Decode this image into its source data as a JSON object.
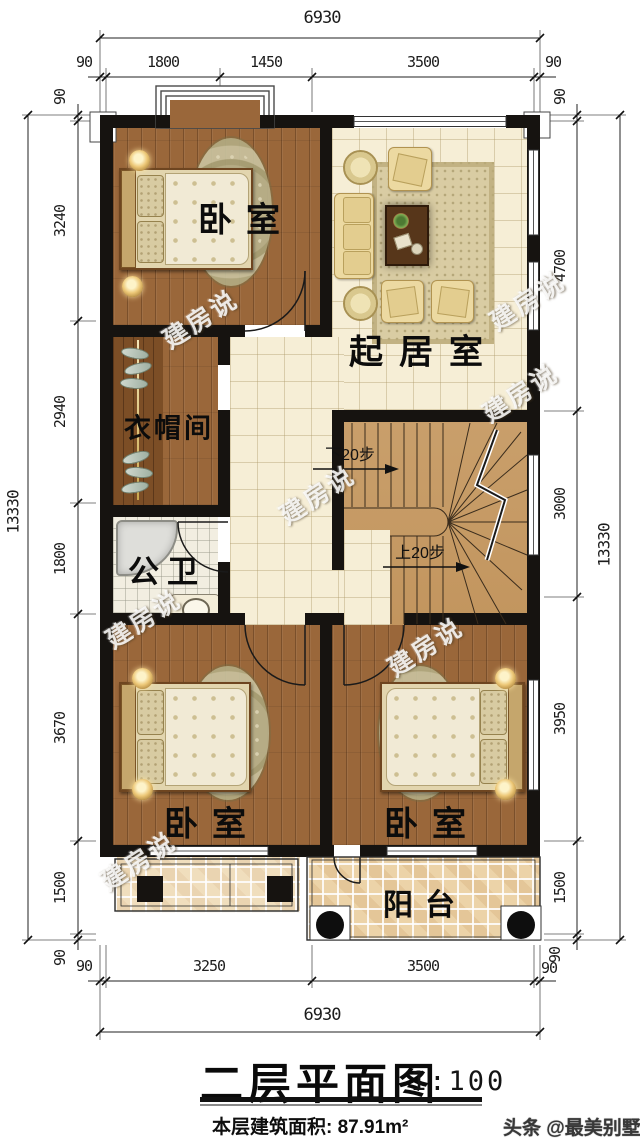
{
  "dims": {
    "top_overall": "6930",
    "top": [
      "90",
      "1800",
      "1450",
      "3500",
      "90"
    ],
    "left_overall": "13330",
    "left": [
      "90",
      "3240",
      "2940",
      "1800",
      "3670",
      "1500",
      "90"
    ],
    "right_overall": "13330",
    "right": [
      "90",
      "4700",
      "3000",
      "3950",
      "1500",
      "90"
    ],
    "bottom": [
      "90",
      "3250",
      "3500",
      "90"
    ],
    "bottom_overall": "6930"
  },
  "rooms": {
    "bedroom_top": "卧室",
    "living": "起居室",
    "cloakroom": "衣帽间",
    "bathroom": "公卫",
    "bedroom_left": "卧室",
    "bedroom_right": "卧室",
    "balcony": "阳台"
  },
  "stairs": {
    "down_label": "下20步",
    "up_label": "上20步"
  },
  "watermark": {
    "text": "建房说",
    "footer": "头条 @最美别墅"
  },
  "title": {
    "name": "二层平面图",
    "scale": "1:100",
    "area": "本层建筑面积: 87.91m²"
  },
  "colors": {
    "wall": "#161310",
    "wood_floor": "#9a673a",
    "tile_floor": "#f6eed6",
    "balcony_tile": "#ecd3a8",
    "stair": "#c69c66",
    "rug": "#b5ae86",
    "sofa": "#ecd9a1"
  }
}
